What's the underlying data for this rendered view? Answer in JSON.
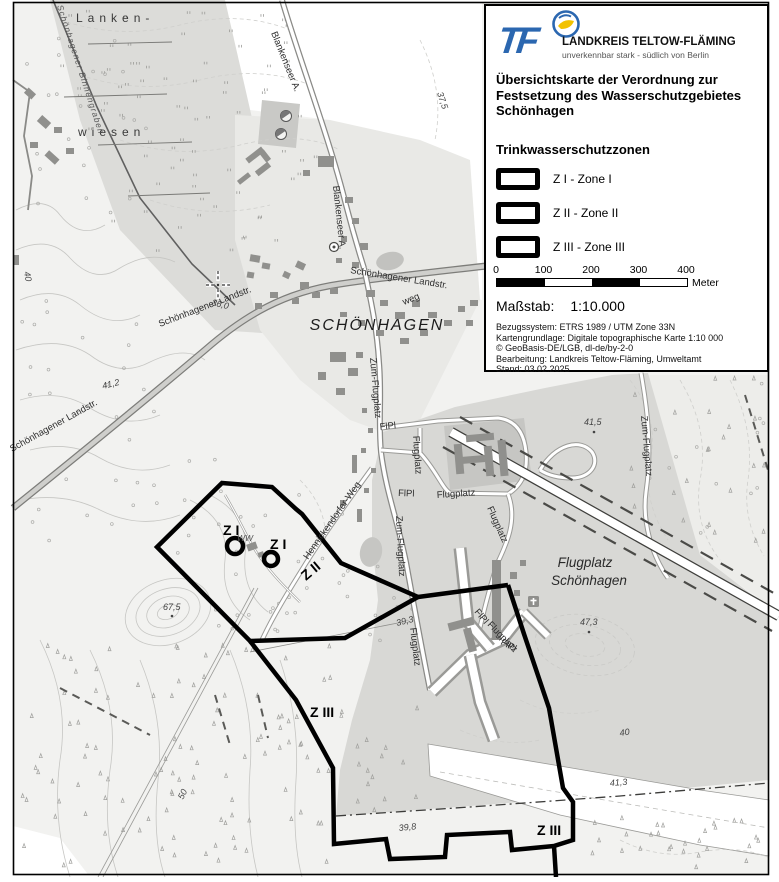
{
  "colors": {
    "brand_blue": "#2b67b0",
    "brand_yellow": "#f2c200",
    "zone_outline": "#000000",
    "meadow_gray": "#dcdcd9",
    "airfield_gray": "#d8d8d5",
    "forest_gray": "#ececea",
    "building_gray": "#90908d"
  },
  "legend_panel": {
    "logo": {
      "tf": "TF",
      "name": "LANDKREIS TELTOW-FLÄMING",
      "tagline": "unverkennbar stark - südlich von Berlin"
    },
    "title_lines": [
      "Übersichtskarte der Verordnung zur",
      "Festsetzung des Wasserschutzgebietes",
      "Schönhagen"
    ],
    "zones_heading": "Trinkwasserschutzzonen",
    "zones": [
      {
        "label": "Z I - Zone I"
      },
      {
        "label": "Z II - Zone II"
      },
      {
        "label": "Z III - Zone III"
      }
    ],
    "scalebar": {
      "ticks": [
        "0",
        "100",
        "200",
        "300",
        "400"
      ],
      "unit": "Meter",
      "segment_pattern": [
        "black",
        "white",
        "black",
        "white"
      ]
    },
    "scale_label": "Maßstab:",
    "scale_value": "1:10.000",
    "meta_lines": [
      "Bezugssystem: ETRS 1989 / UTM Zone 33N",
      "Kartengrundlage: Digitale topographische Karte 1:10 000",
      "© GeoBasis-DE/LGB, dl-de/by-2-0",
      "Bearbeitung: Landkreis Teltow-Fläming, Umweltamt",
      "Stand: 03.02.2025"
    ]
  },
  "map": {
    "labels": [
      {
        "text": "Lanken-",
        "x": 76,
        "y": 22,
        "rot": 0,
        "cls": "area"
      },
      {
        "text": "wiesen",
        "x": 78,
        "y": 136,
        "rot": 0,
        "cls": "area"
      },
      {
        "text": "Schönhagener Binnengraben",
        "x": 57,
        "y": 6,
        "rot": 72,
        "cls": "water"
      },
      {
        "text": "Blankenseer A.",
        "x": 271,
        "y": 33,
        "rot": 68,
        "cls": "road"
      },
      {
        "text": "Blankenseer A.",
        "x": 333,
        "y": 186,
        "rot": 84,
        "cls": "road"
      },
      {
        "text": "Schönhagener Landstr.",
        "x": 350,
        "y": 273,
        "rot": 9,
        "cls": "road"
      },
      {
        "text": "Schönhagener Landstr.",
        "x": 160,
        "y": 327,
        "rot": -21,
        "cls": "road"
      },
      {
        "text": "Schönhagener Landstr.",
        "x": 12,
        "y": 452,
        "rot": -29,
        "cls": "road"
      },
      {
        "text": "weg",
        "x": 404,
        "y": 305,
        "rot": -22,
        "cls": "road"
      },
      {
        "text": "SCHÖNHAGEN",
        "x": 377,
        "y": 330,
        "rot": 0,
        "cls": "place",
        "anchor": "middle"
      },
      {
        "text": "Zum-Flugplatz",
        "x": 370,
        "y": 358,
        "rot": 85,
        "cls": "road"
      },
      {
        "text": "Zum-Flugplatz",
        "x": 396,
        "y": 516,
        "rot": 87,
        "cls": "road"
      },
      {
        "text": "Zum-Flugplatz",
        "x": 641,
        "y": 416,
        "rot": 85,
        "cls": "road"
      },
      {
        "text": "Hennickendorfer-Weg",
        "x": 308,
        "y": 560,
        "rot": -55,
        "cls": "road"
      },
      {
        "text": "FlPl",
        "x": 380,
        "y": 430,
        "rot": -6,
        "cls": "road"
      },
      {
        "text": "Flugplatz",
        "x": 413,
        "y": 436,
        "rot": 86,
        "cls": "road"
      },
      {
        "text": "FlPl",
        "x": 398,
        "y": 496,
        "rot": 2,
        "cls": "road"
      },
      {
        "text": "Flugplatz",
        "x": 437,
        "y": 498,
        "rot": -4,
        "cls": "road"
      },
      {
        "text": "Flugplatz",
        "x": 487,
        "y": 508,
        "rot": 66,
        "cls": "road"
      },
      {
        "text": "FlPl",
        "x": 474,
        "y": 612,
        "rot": 50,
        "cls": "road"
      },
      {
        "text": "Flugplatz",
        "x": 487,
        "y": 625,
        "rot": 46,
        "cls": "road"
      },
      {
        "text": "FlPl",
        "x": 500,
        "y": 644,
        "rot": 28,
        "cls": "road"
      },
      {
        "text": "Flugplatz",
        "x": 410,
        "y": 628,
        "rot": 83,
        "cls": "road"
      },
      {
        "text": "Flugplatz",
        "x": 585,
        "y": 567,
        "rot": 0,
        "cls": "place2",
        "anchor": "middle"
      },
      {
        "text": "Schönhagen",
        "x": 589,
        "y": 585,
        "rot": 0,
        "cls": "place2",
        "anchor": "middle"
      },
      {
        "text": "37,5",
        "x": 437,
        "y": 93,
        "rot": 72,
        "cls": "elev"
      },
      {
        "text": "36,0",
        "x": 211,
        "y": 305,
        "rot": 14,
        "cls": "elev"
      },
      {
        "text": "41,2",
        "x": 103,
        "y": 389,
        "rot": -14,
        "cls": "elev"
      },
      {
        "text": "67,5",
        "x": 163,
        "y": 610,
        "rot": 0,
        "cls": "elev"
      },
      {
        "text": "41,5",
        "x": 584,
        "y": 425,
        "rot": 0,
        "cls": "elev"
      },
      {
        "text": "47,3",
        "x": 580,
        "y": 625,
        "rot": 0,
        "cls": "elev"
      },
      {
        "text": "39,3",
        "x": 397,
        "y": 626,
        "rot": -14,
        "cls": "elev"
      },
      {
        "text": "39,8",
        "x": 399,
        "y": 831,
        "rot": -6,
        "cls": "elev"
      },
      {
        "text": "41,3",
        "x": 610,
        "y": 786,
        "rot": -4,
        "cls": "elev"
      },
      {
        "text": "50",
        "x": 183,
        "y": 800,
        "rot": -64,
        "cls": "elev"
      },
      {
        "text": "40",
        "x": 24,
        "y": 272,
        "rot": 80,
        "cls": "elev"
      },
      {
        "text": "40",
        "x": 620,
        "y": 736,
        "rot": -8,
        "cls": "elev"
      },
      {
        "text": "WW",
        "x": 237,
        "y": 541,
        "rot": 0,
        "cls": "smalli"
      },
      {
        "text": "Z I",
        "x": 223,
        "y": 535,
        "rot": 0,
        "cls": "zone"
      },
      {
        "text": "Z I",
        "x": 270,
        "y": 549,
        "rot": 0,
        "cls": "zone"
      },
      {
        "text": "Z II",
        "x": 306,
        "y": 581,
        "rot": -40,
        "cls": "zone"
      },
      {
        "text": "Z III",
        "x": 310,
        "y": 717,
        "rot": 0,
        "cls": "zone"
      },
      {
        "text": "Z III",
        "x": 537,
        "y": 835,
        "rot": 0,
        "cls": "zone"
      }
    ]
  },
  "cursor": {
    "x": 218,
    "y": 285
  }
}
